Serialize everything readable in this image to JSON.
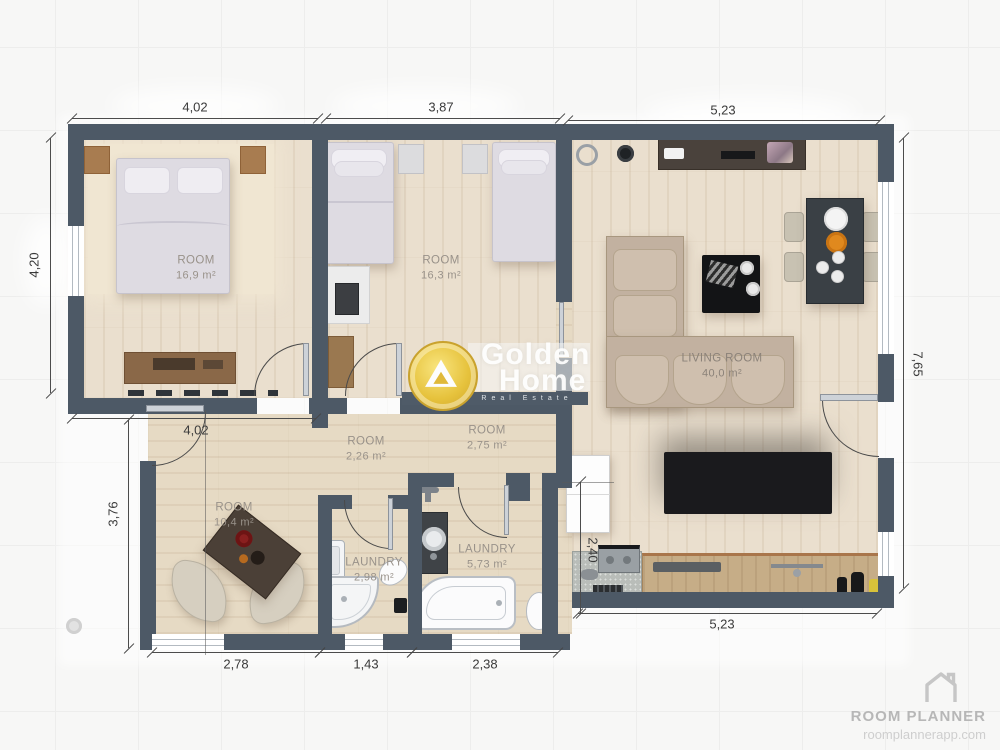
{
  "branding": {
    "app_name": "ROOM PLANNER",
    "app_url": "roomplannerapp.com"
  },
  "watermark": {
    "brand_line1": "Golden",
    "brand_line2": "Home",
    "tagline": "Real Estate"
  },
  "rooms": [
    {
      "id": "bedroom-1",
      "name": "ROOM",
      "area": "16,9 m²"
    },
    {
      "id": "bedroom-2",
      "name": "ROOM",
      "area": "16,3 m²"
    },
    {
      "id": "living-room",
      "name": "LIVING ROOM",
      "area": "40,0 m²"
    },
    {
      "id": "hall-1",
      "name": "ROOM",
      "area": "2,26 m²"
    },
    {
      "id": "hall-2",
      "name": "ROOM",
      "area": "2,75 m²"
    },
    {
      "id": "sitting-room",
      "name": "ROOM",
      "area": "10,4 m²"
    },
    {
      "id": "laundry-1",
      "name": "LAUNDRY",
      "area": "2,98 m²"
    },
    {
      "id": "laundry-2",
      "name": "LAUNDRY",
      "area": "5,73 m²"
    }
  ],
  "dimensions": {
    "top_left": "4,02",
    "top_middle": "3,87",
    "top_right": "5,23",
    "left_upper": "4,20",
    "left_lower": "3,76",
    "right_side": "7,65",
    "middle": "4,02",
    "kitchen_height": "2,40",
    "bottom_1": "2,78",
    "bottom_2": "1,43",
    "bottom_3": "2,38",
    "bottom_right": "5,23"
  },
  "colors": {
    "wall": "#4d5966",
    "floor": "#eadfce",
    "gold": "#e9c94d",
    "sofa": "#c9b9a8",
    "rug": "#1b1b1e",
    "counter": "#c6ad87"
  }
}
